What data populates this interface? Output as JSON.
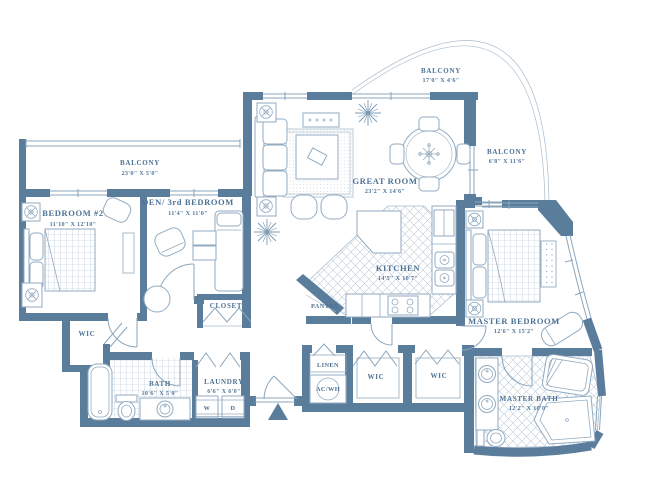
{
  "title": "Condominium residence floor plan",
  "colors": {
    "wall": "#5b7d9c",
    "line": "#8aa6bd",
    "light_line": "#a9becf",
    "label": "#4d7294",
    "background": "#ffffff"
  },
  "rooms": {
    "balcony_left": {
      "name": "BALCONY",
      "dims": "23'0\" X 5'0\""
    },
    "bedroom2": {
      "name": "BEDROOM #2",
      "dims": "11'10\" X 12'10\""
    },
    "den": {
      "name": "DEN/ 3rd BEDROOM",
      "dims": "11'4\" X 11'0\""
    },
    "closet": {
      "name": "CLOSET"
    },
    "wic_bedroom2": {
      "name": "WIC"
    },
    "bath2": {
      "name": "BATH",
      "dims": "10'6\" X 5'0\""
    },
    "laundry": {
      "name": "LAUNDRY",
      "dims": "6'6\" X 6'0\"",
      "washer": "W",
      "dryer": "D"
    },
    "great_room": {
      "name": "GREAT ROOM",
      "dims": "23'2\" X 14'6\""
    },
    "balcony_top": {
      "name": "BALCONY",
      "dims": "17'0\" X 4'6\""
    },
    "balcony_right": {
      "name": "BALCONY",
      "dims": "6'8\" X 11'6\""
    },
    "kitchen": {
      "name": "KITCHEN",
      "dims": "14'5\" X 10'7\""
    },
    "pantry": {
      "name": "PANTRY"
    },
    "linen": {
      "name": "LINEN"
    },
    "ac_wh": {
      "name": "AC/WH"
    },
    "wic1": {
      "name": "WIC"
    },
    "wic2": {
      "name": "WIC"
    },
    "master_bedroom": {
      "name": "MASTER BEDROOM",
      "dims": "12'6\" X 15'2\""
    },
    "master_bath": {
      "name": "MASTER BATH",
      "dims": "12'2\" X 10'0\""
    }
  }
}
